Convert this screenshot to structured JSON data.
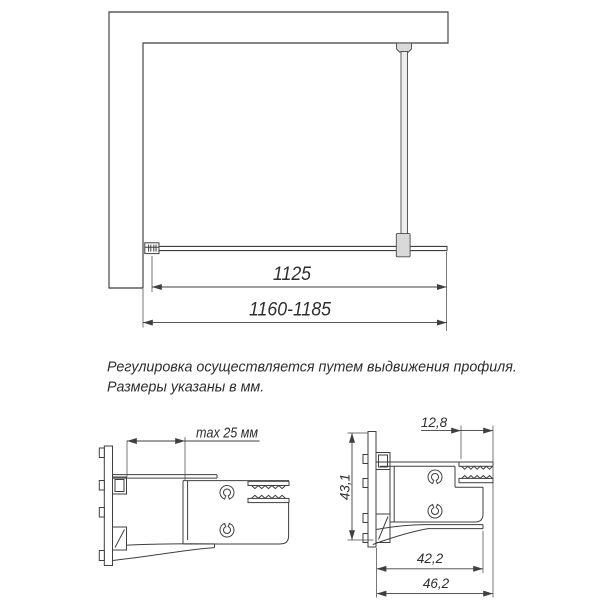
{
  "plan_view": {
    "dim_glass_width": "1125",
    "dim_overall_width": "1160-1185"
  },
  "notes": {
    "line1": "Регулировка осуществляется путем выдвижения профиля.",
    "line2": "Размеры указаны в мм."
  },
  "left_profile_section": {
    "dim_max_extension": "max 25 мм"
  },
  "right_profile_section": {
    "dim_glass_channel": "12,8",
    "dim_profile_height": "43,1",
    "dim_profile_depth": "42,2",
    "dim_profile_overall": "46,2"
  },
  "colors": {
    "line": "#3f3f3f",
    "fill_light_gray": "#d9d9d9",
    "background": "#ffffff"
  }
}
